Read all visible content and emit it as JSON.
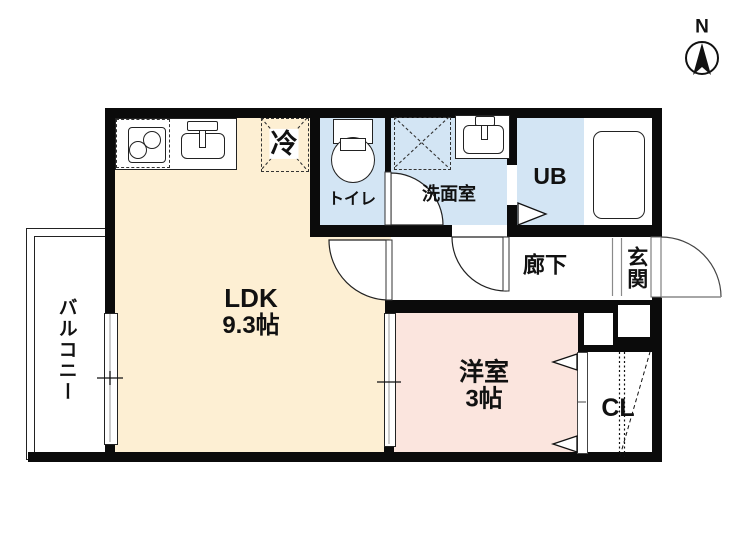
{
  "title": "1LDK floor plan",
  "compass": {
    "north_label": "N"
  },
  "rooms": {
    "ldk": {
      "label": "LDK",
      "size": "9.3帖"
    },
    "western": {
      "label": "洋室",
      "size": "3帖"
    },
    "toilet": {
      "label": "トイレ"
    },
    "washroom": {
      "label": "洗面室"
    },
    "bath": {
      "label": "UB"
    },
    "hallway": {
      "label": "廊下"
    },
    "entrance": {
      "label": "玄関"
    },
    "balcony": {
      "label": "バルコニー"
    },
    "closet": {
      "label": "CL"
    }
  },
  "fixtures": {
    "refrigerator": {
      "label": "冷"
    }
  },
  "colors": {
    "ldk_floor": "#FDEFD3",
    "western_room_floor": "#FBE5DE",
    "wet_area_floor": "#D3E5F4",
    "wall": "#0B0B0B"
  }
}
